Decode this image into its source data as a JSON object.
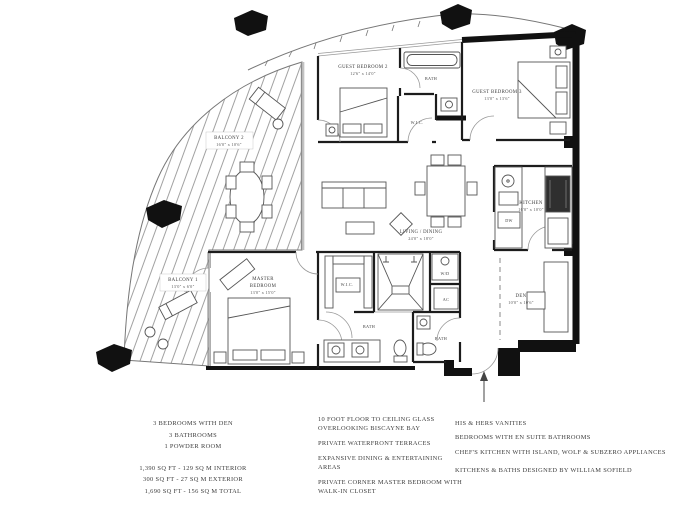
{
  "plan": {
    "labels": {
      "guest_bedroom_2": {
        "name": "GUEST BEDROOM 2",
        "dims": "12'6\" x 14'0\""
      },
      "guest_bedroom_3": {
        "name": "GUEST BEDROOM 3",
        "dims": "13'0\" x 13'6\""
      },
      "bath_top": "BATH",
      "wic_guest": "W.I.C.",
      "kitchen": {
        "name": "KITCHEN",
        "dims": "16'0\" x 10'0\""
      },
      "den": {
        "name": "DEN",
        "dims": "10'0\" x 10'6\""
      },
      "living_dining": {
        "name": "LIVING / DINING",
        "dims": "24'0\" x 18'0\""
      },
      "master_bedroom": {
        "line1": "MASTER",
        "line2": "BEDROOM",
        "dims": "13'0\" x 15'0\""
      },
      "balcony_2": {
        "name": "BALCONY 2",
        "dims": "16'0\" x 10'6\""
      },
      "balcony_1": {
        "name": "BALCONY 1",
        "dims": "13'0\" x 6'0\""
      },
      "wic_master": "W.I.C.",
      "bath_master": "BATH",
      "bath_powder": "BATH",
      "washer_dryer": "W/D",
      "ac": "AC",
      "dishwasher": "DW"
    },
    "colors": {
      "wall": "#1c1c1c",
      "thin_line": "#777777",
      "furniture": "#555555",
      "hatch": "#8a8a8a"
    }
  },
  "legend": {
    "summary": [
      "3 BEDROOMS WITH DEN",
      "3 BATHROOMS",
      "1 POWDER ROOM"
    ],
    "areas": [
      "1,390 SQ FT - 129 SQ M INTERIOR",
      "300 SQ FT - 27 SQ M EXTERIOR",
      "1,690 SQ FT - 156 SQ M TOTAL"
    ],
    "features_left": [
      "10 FOOT FLOOR TO CEILING GLASS OVERLOOKING BISCAYNE BAY",
      "PRIVATE WATERFRONT TERRACES",
      "EXPANSIVE DINING & ENTERTAINING AREAS",
      "PRIVATE CORNER MASTER BEDROOM WITH WALK-IN CLOSET"
    ],
    "features_right": [
      "HIS & HERS VANITIES",
      "BEDROOMS WITH EN SUITE BATHROOMS",
      "CHEF'S KITCHEN WITH ISLAND, WOLF & SUBZERO APPLIANCES",
      "KITCHENS & BATHS DESIGNED BY WILLIAM SOFIELD"
    ]
  }
}
